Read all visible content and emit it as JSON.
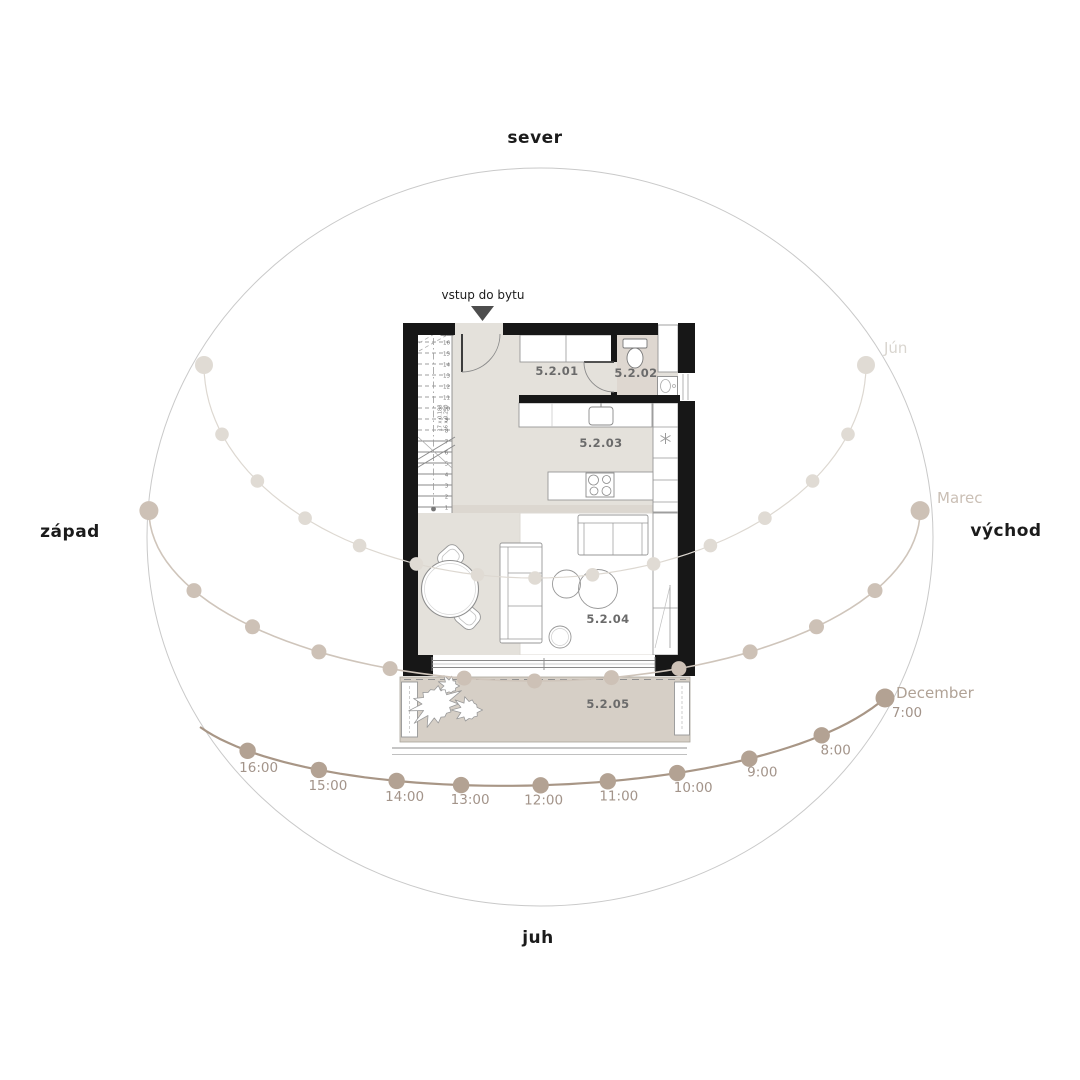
{
  "compass": {
    "north": "sever",
    "south": "juh",
    "west": "západ",
    "east": "východ"
  },
  "entrance": {
    "label": "vstup do bytu"
  },
  "rooms": [
    "5.2.01",
    "5.2.02",
    "5.2.03",
    "5.2.04",
    "5.2.05"
  ],
  "stairs": {
    "numbers": [
      "1",
      "2",
      "3",
      "4",
      "5",
      "6",
      "7",
      "8",
      "9",
      "10",
      "11",
      "12",
      "13",
      "14",
      "15",
      "16",
      "17"
    ],
    "note1": "17 x 0.188",
    "note2": "16 x 0.250"
  },
  "sun_diagram": {
    "months": {
      "june": "Jún",
      "march": "Marec",
      "december": "December"
    },
    "december_times": [
      "16:00",
      "15:00",
      "14:00",
      "13:00",
      "12:00",
      "11:00",
      "10:00",
      "9:00",
      "8:00",
      "7:00"
    ]
  },
  "colors": {
    "wall": "#171717",
    "floor": "#e4e1db",
    "floor_wc": "#ded7d0",
    "terrace": "#d6cfc6",
    "outline": "#979797",
    "room_label": "#6b6b6b",
    "dark_text": "#1b1b1b",
    "horizon": "#c9c9c9",
    "june_line": "#ddd8d1",
    "june_dot": "#e0dbd4",
    "june_text": "#d9d5cf",
    "march_line": "#cfc5bb",
    "march_dot": "#cdc1b6",
    "march_text": "#cabfb5",
    "december_line": "#a89686",
    "december_dot": "#b3a293",
    "december_text": "#b0a296",
    "time_text": "#a3948a"
  }
}
